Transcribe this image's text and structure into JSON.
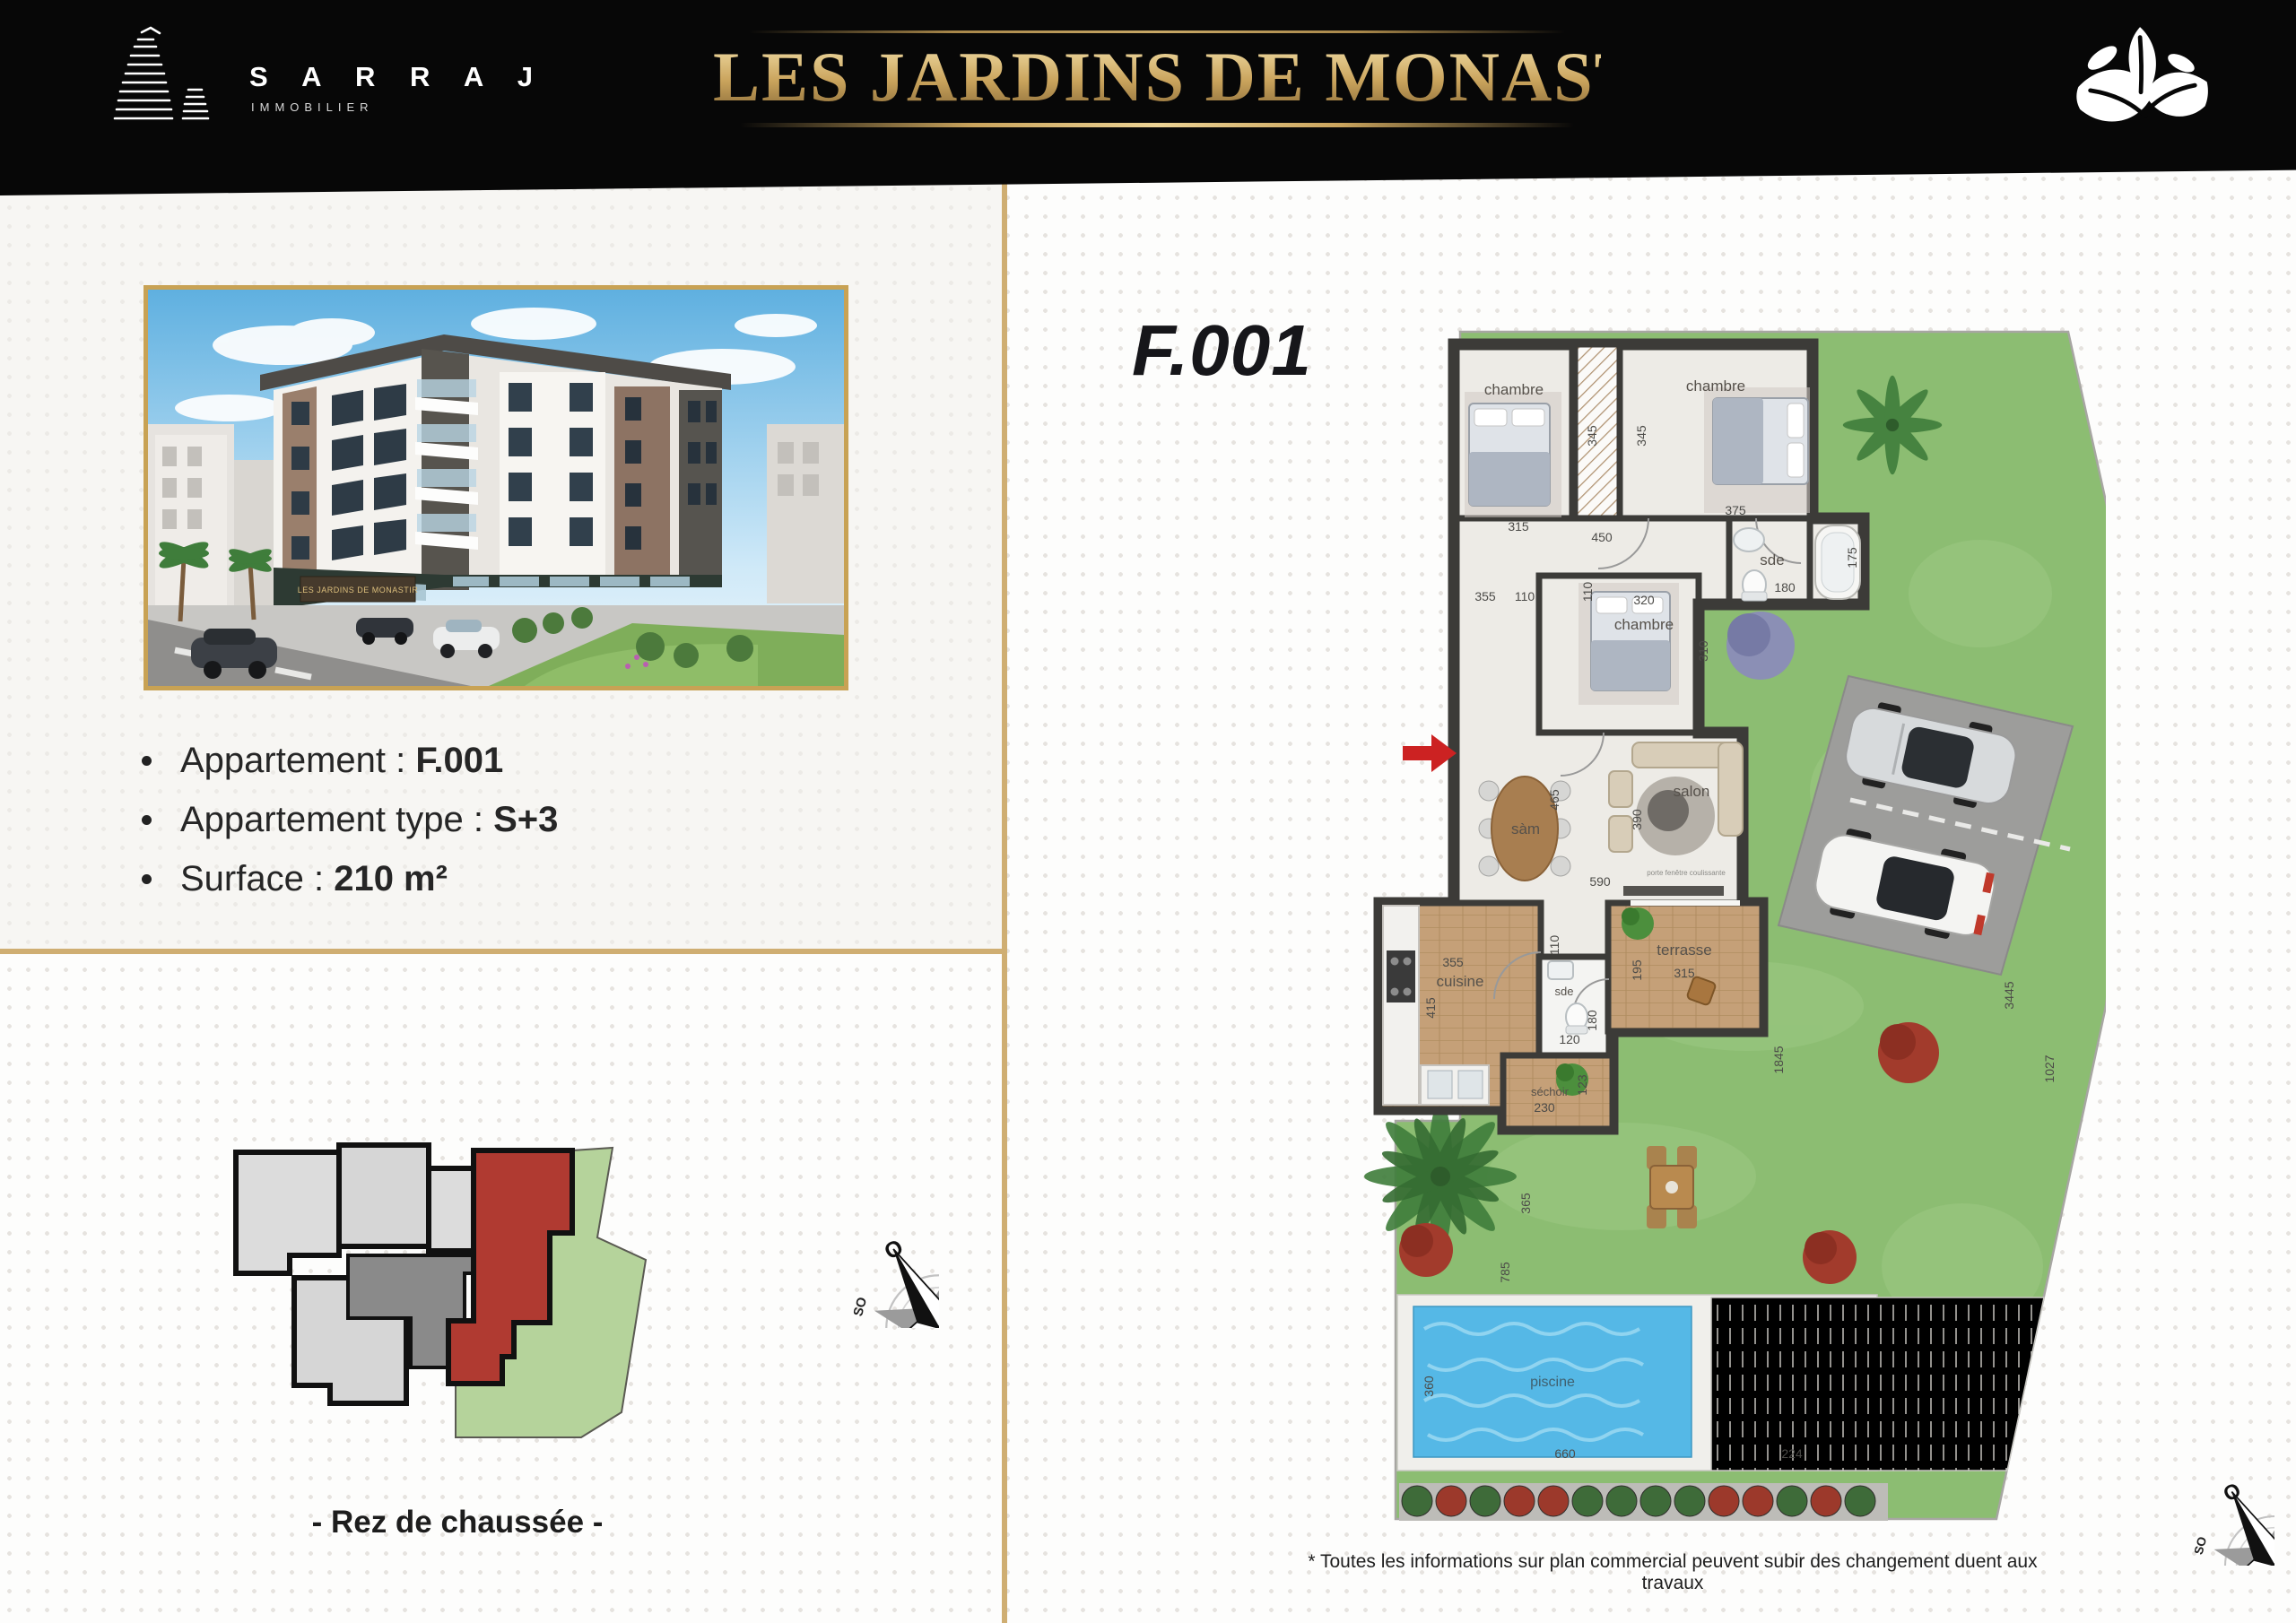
{
  "header": {
    "brand_name": "S A R R A J",
    "brand_sub": "IMMOBILIER",
    "title": "LES JARDINS DE MONASTIR"
  },
  "info": {
    "items": [
      {
        "label": "Appartement : ",
        "value": "F.001"
      },
      {
        "label": "Appartement type : ",
        "value": "S+3"
      },
      {
        "label": "Surface : ",
        "value": "210 m²"
      }
    ],
    "floor_caption": "- Rez de chaussée -"
  },
  "render": {
    "sign": "LES JARDINS DE MONASTIR"
  },
  "plan": {
    "unit_code": "F.001",
    "rooms": {
      "chambre": "chambre",
      "sde": "sde",
      "cuisine": "cuisine",
      "sechoir": "séchoir",
      "terrasse": "terrasse",
      "salon": "salon",
      "sam": "sàm",
      "piscine": "piscine",
      "door_note": "porte fenêtre coulissante"
    },
    "dims": [
      "345",
      "345",
      "315",
      "375",
      "450",
      "110",
      "355",
      "110",
      "320",
      "180",
      "175",
      "310",
      "465",
      "390",
      "590",
      "110",
      "355",
      "415",
      "180",
      "120",
      "230",
      "123",
      "195",
      "315",
      "1845",
      "365",
      "785",
      "360",
      "660",
      "224",
      "1027",
      "3445"
    ]
  },
  "compass": {
    "n": "N",
    "ne": "NE",
    "e": "E",
    "se": "SE",
    "s": "S",
    "so": "SO",
    "o": "O",
    "no": "NO"
  },
  "footnote": "* Toutes les informations sur plan commercial peuvent subir des changement duent aux travaux",
  "colors": {
    "gold": "#c9a45b",
    "header_bg": "#070707",
    "accent_red": "#cc2222",
    "unit_red": "#b03a31",
    "garden_green": "#8cbd72",
    "pool_blue": "#55b8e6"
  }
}
